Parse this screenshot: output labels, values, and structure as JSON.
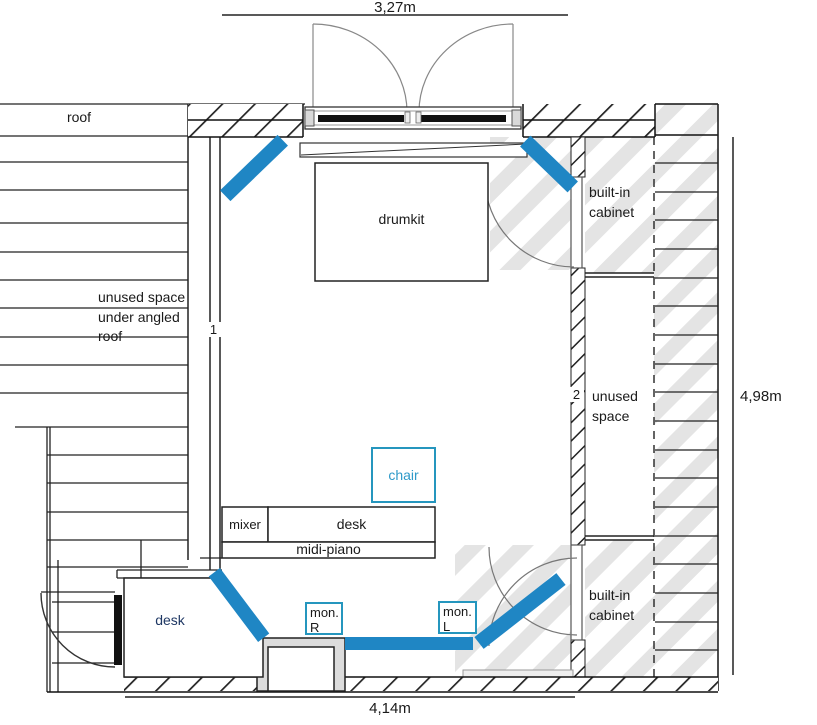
{
  "plan": {
    "title": "room floor plan",
    "dimensions": {
      "top": "3,27m",
      "right": "4,98m",
      "bottom": "4,14m"
    },
    "labels": {
      "roof": "roof",
      "unused_left_line1": "unused space",
      "unused_left_line2": "under angled",
      "unused_left_line3": "roof",
      "wall_marker_1": "1",
      "wall_marker_2": "2",
      "drumkit": "drumkit",
      "chair": "chair",
      "mixer": "mixer",
      "desk": "desk",
      "midi_piano": "midi-piano",
      "corner_desk": "desk",
      "monitor_right_line1": "mon.",
      "monitor_right_line2": "R",
      "monitor_left_line1": "mon.",
      "monitor_left_line2": "L",
      "cabinet_top_line1": "built-in",
      "cabinet_top_line2": "cabinet",
      "unused_right_line1": "unused",
      "unused_right_line2": "space",
      "cabinet_bottom_line1": "built-in",
      "cabinet_bottom_line2": "cabinet"
    },
    "colors": {
      "speaker_blue": "#1F86C4",
      "teal_accent": "#2596BE",
      "corner_desk_text": "#1F3864",
      "roof_stripe_gray": "#E4E4E4"
    }
  }
}
